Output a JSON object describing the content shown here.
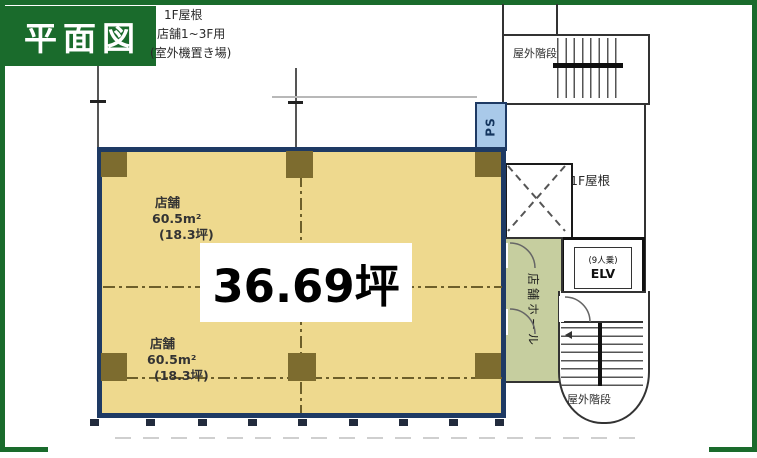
{
  "title": "平面図",
  "roof_note": {
    "line1": "1F屋根",
    "line2": "店舗1~3F用",
    "line3": "(室外機置き場)"
  },
  "rooms": {
    "stairs_top": "屋外階段",
    "stairs_bottom": "屋外階段",
    "roof_1f": "1F屋根",
    "ps": "PS",
    "hall": "店舗ホール",
    "elevator": {
      "capacity": "(9人乗)",
      "label": "ELV"
    }
  },
  "shops": [
    {
      "name": "店舗",
      "area_m2": "60.5m²",
      "area_tsubo": "(18.3坪)"
    },
    {
      "name": "店舗",
      "area_m2": "60.5m²",
      "area_tsubo": "(18.3坪)"
    }
  ],
  "total_area": "36.69坪",
  "colors": {
    "green": "#1a6b2c",
    "navy": "#1e3a64",
    "tan": "#eed98e",
    "column": "#7d6c2f",
    "hall": "#c6ce9f",
    "ps_blue": "#a9c9e9"
  }
}
